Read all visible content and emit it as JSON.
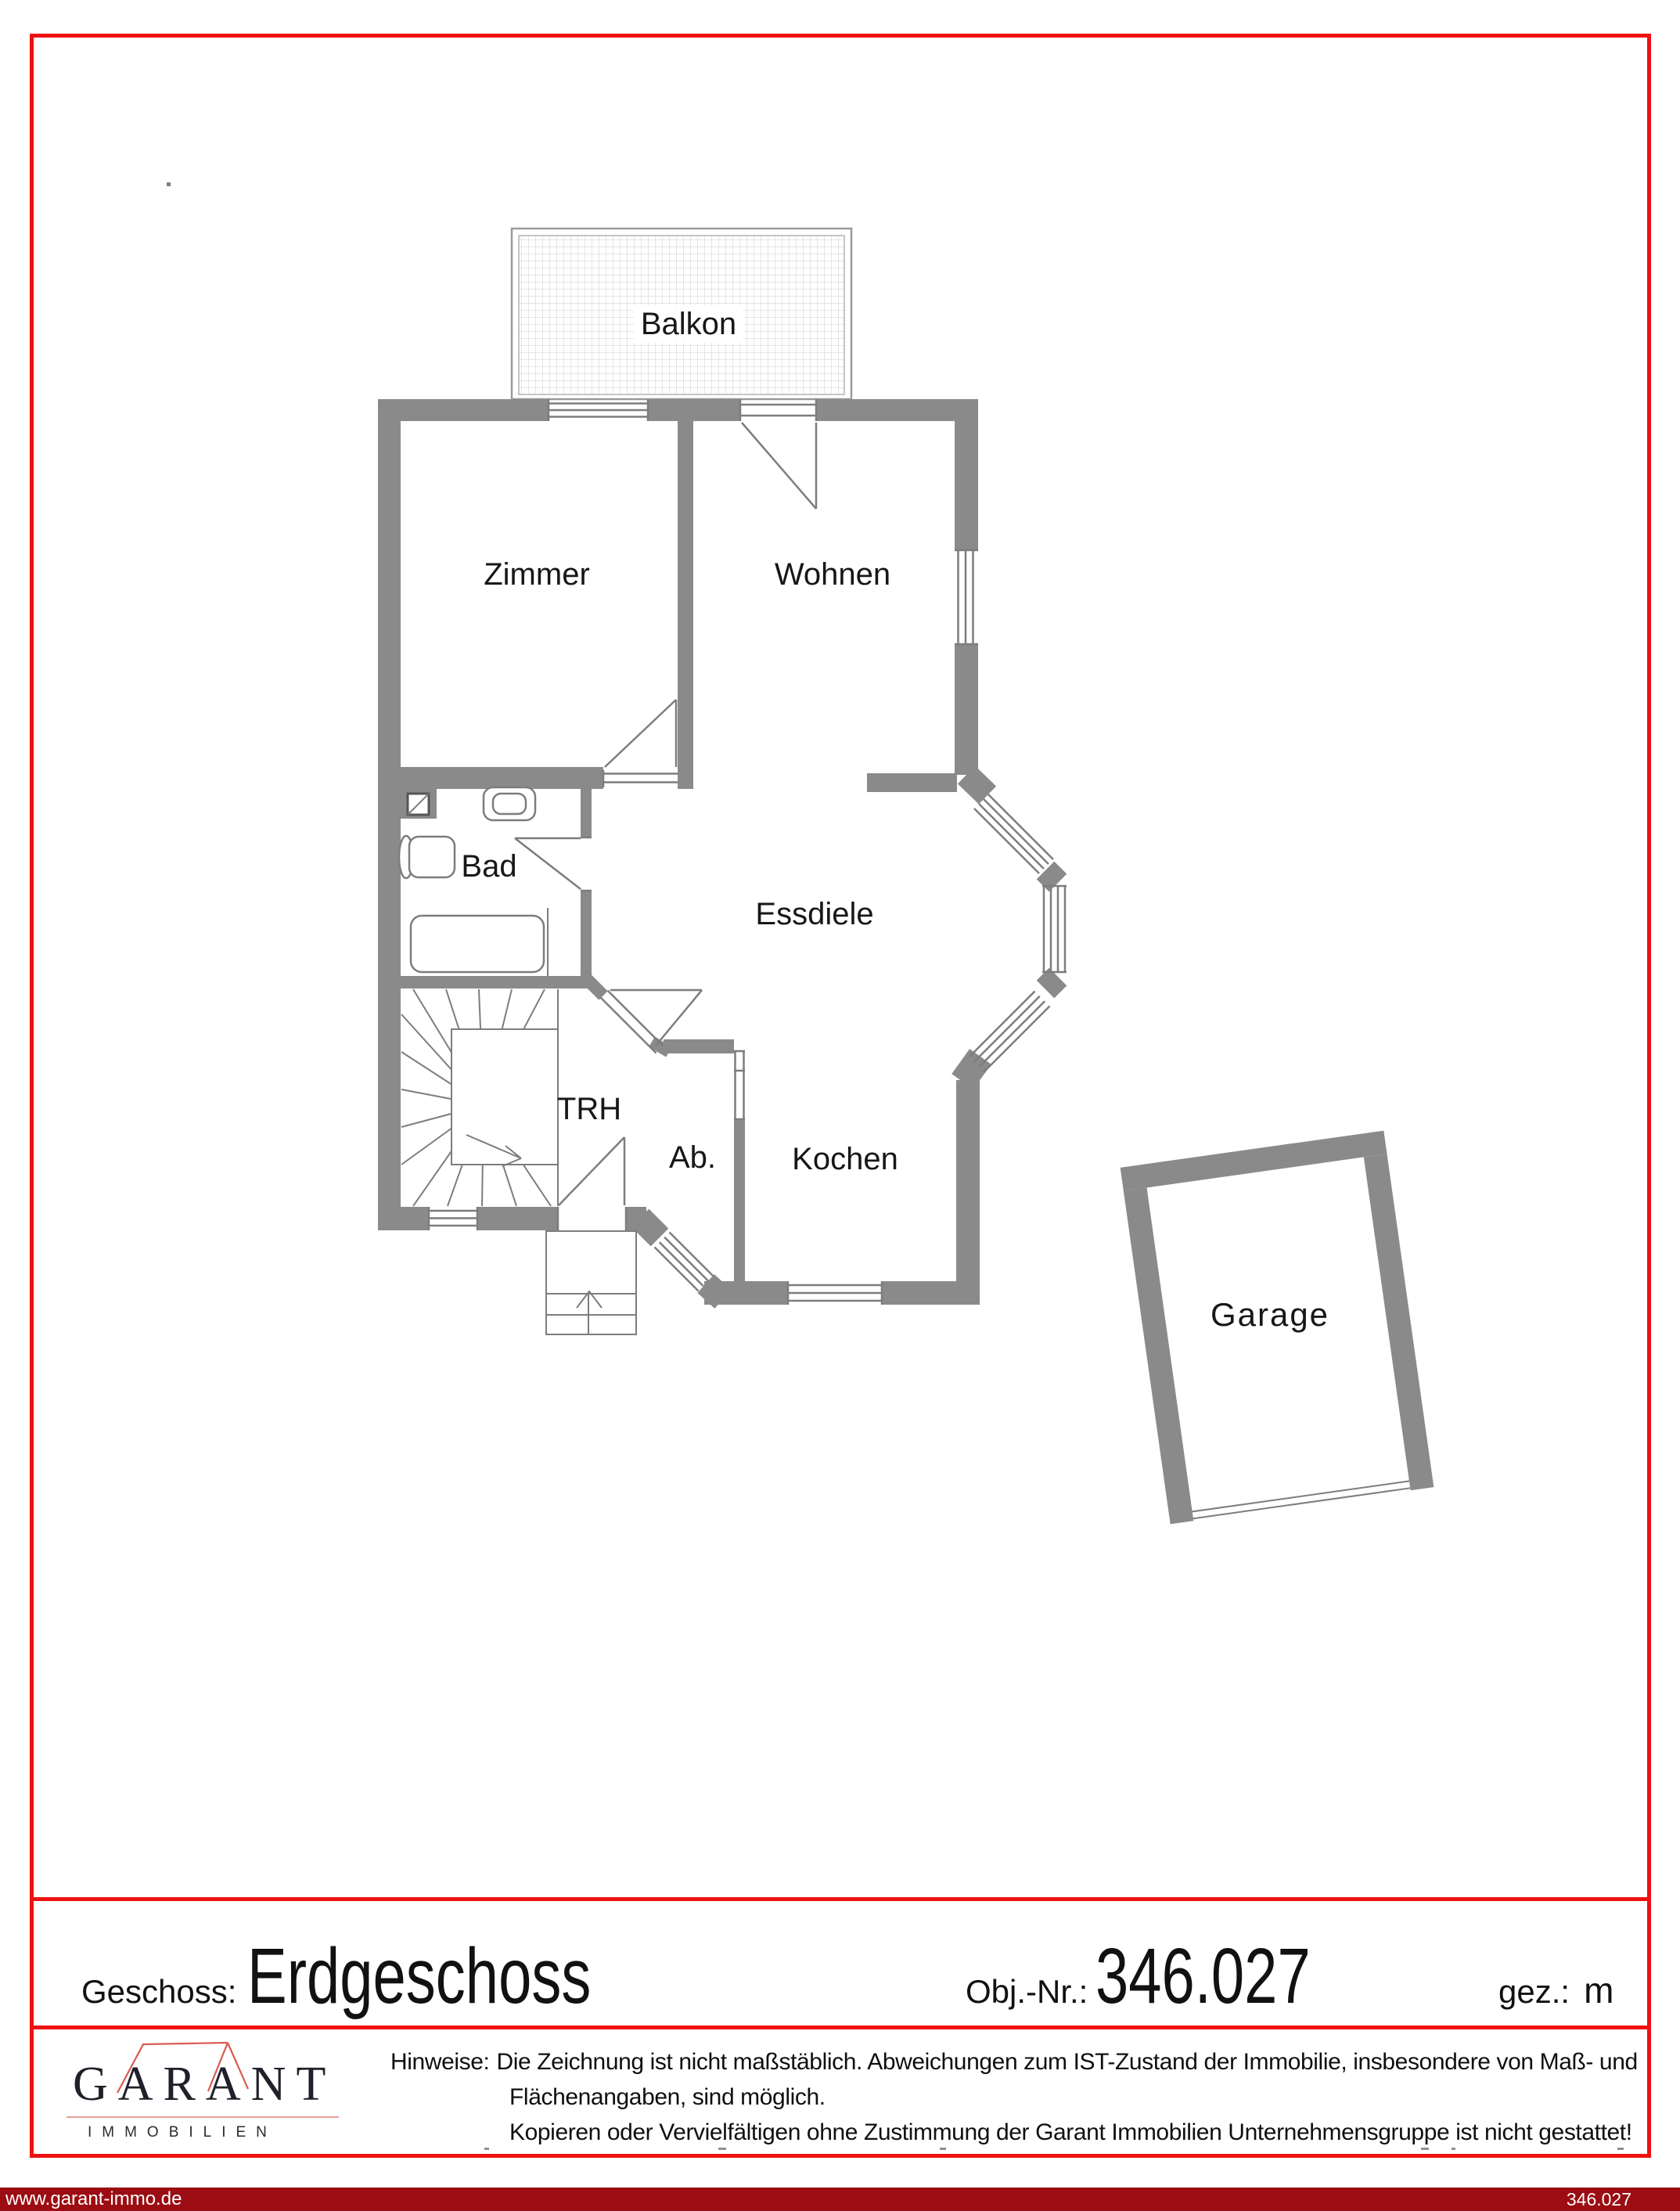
{
  "plan": {
    "rooms": {
      "balkon": "Balkon",
      "zimmer": "Zimmer",
      "wohnen": "Wohnen",
      "bad": "Bad",
      "essdiele": "Essdiele",
      "trh": "TRH",
      "ab": "Ab.",
      "kochen": "Kochen",
      "garage": "Garage"
    }
  },
  "document": {
    "meta": {
      "geschoss_label": "Geschoss:",
      "geschoss_value": "Erdgeschoss",
      "obj_label": "Obj.-Nr.:",
      "obj_value": "346.027",
      "gez_label": "gez.:",
      "gez_value": "m"
    },
    "logo": {
      "title": "GARANT",
      "subtitle": "IMMOBILIEN"
    },
    "hinweise": {
      "label": "Hinweise:",
      "line1": "Die Zeichnung ist nicht maßstäblich. Abweichungen zum IST-Zustand der Immobilie, insbesondere von Maß- und",
      "line2": "Flächenangaben, sind möglich.",
      "line3": "Kopieren oder Vervielfältigen ohne Zustimmung der Garant Immobilien Unternehmensgruppe ist nicht gestattet!"
    },
    "footer_bar": {
      "left": "www.garant-immo.de",
      "right": "346.027"
    }
  },
  "colors": {
    "page_border": "#ee1111",
    "footer_bar_bg": "#9b0d12",
    "wall_gray": "#8a8a8a",
    "plan_line_gray": "#7d7d7d",
    "logo_red": "#d95a52"
  }
}
